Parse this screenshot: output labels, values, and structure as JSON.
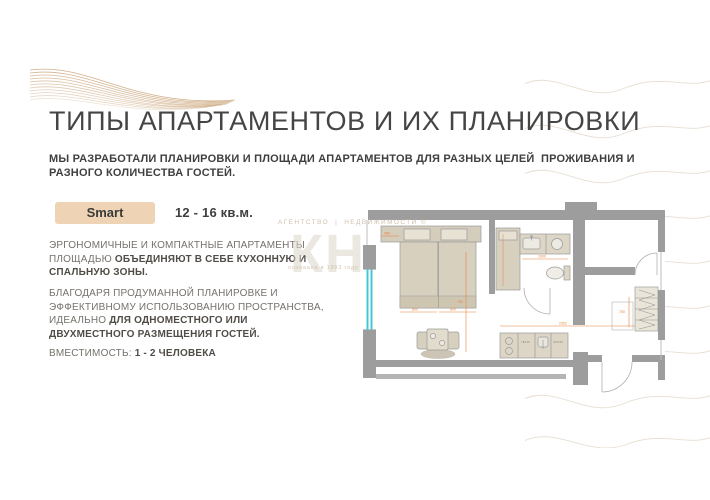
{
  "slide": {
    "title": "ТИПЫ АПАРТАМЕНТОВ И ИХ ПЛАНИРОВКИ",
    "subtitle": "МЫ РАЗРАБОТАЛИ ПЛАНИРОВКИ И ПЛОЩАДИ АПАРТАМЕНТОВ ДЛЯ РАЗНЫХ ЦЕЛЕЙ  ПРОЖИВАНИЯ И\nРАЗНОГО КОЛИЧЕСТВА ГОСТЕЙ."
  },
  "apartment": {
    "type_label": "Smart",
    "area_range": "12 - 16 кв.м.",
    "paragraph1": {
      "normal": "ЭРГОНОМИЧНЫЕ И КОМПАКТНЫЕ АПАРТАМЕНТЫ ПЛОЩАДЬЮ ",
      "bold": "ОБЪЕДИНЯЮТ В СЕБЕ КУХОННУЮ И СПАЛЬНУЮ ЗОНЫ."
    },
    "paragraph2": {
      "normal": "БЛАГОДАРЯ ПРОДУМАННОЙ ПЛАНИРОВКЕ И ЭФФЕКТИВНОМУ ИСПОЛЬЗОВАНИЮ ПРОСТРАНСТВА, ИДЕАЛЬНО ",
      "bold": "ДЛЯ ОДНОМЕСТНОГО ИЛИ ДВУХМЕСТНОГО РАЗМЕЩЕНИЯ ГОСТЕЙ."
    },
    "capacity": {
      "label": "ВМЕСТИМОСТЬ: ",
      "value": "1 - 2 ЧЕЛОВЕКА"
    }
  },
  "watermark": {
    "agency": "АГЕНТСТВО",
    "separator": "|",
    "realty": "НЕДВИЖИМОСТИ ©",
    "big_text": "КН",
    "founded": "основана в 1993 году"
  },
  "floor_plan": {
    "dimensions": [
      "450",
      "800",
      "800",
      "750",
      "1000",
      "2352",
      "700"
    ],
    "kitchen_labels": [
      "ПМ 45",
      "ХОЛ 60"
    ]
  },
  "colors": {
    "accent_tan": "#eed4b5",
    "wave_tan": "#c9a175",
    "wall_gray": "#9d9d9d",
    "furniture_beige": "#d8d0bf",
    "dimension_orange": "#e8823c",
    "window_cyan": "#45c7d8"
  }
}
